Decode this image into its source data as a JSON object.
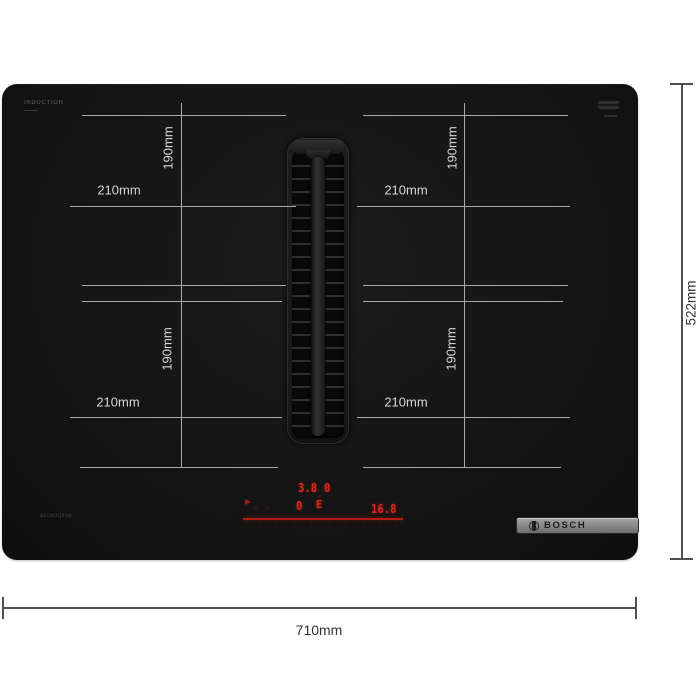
{
  "page": {
    "background": "#ffffff"
  },
  "hob": {
    "markings": {
      "top_left": "INDUCTION",
      "bottom_left": "accent|line"
    },
    "badge_brand": "BOSCH",
    "colors": {
      "surface": "#151515",
      "display_red": "#d8281c",
      "badge_gray": "#8c8c8c",
      "inner_dim_line": "#a8a8a8",
      "outer_dim_line": "#4f4f4f"
    }
  },
  "zones": [
    {
      "id": "top-left",
      "width_label": "210mm",
      "height_label": "190mm"
    },
    {
      "id": "top-right",
      "width_label": "210mm",
      "height_label": "190mm"
    },
    {
      "id": "bottom-left",
      "width_label": "210mm",
      "height_label": "190mm"
    },
    {
      "id": "bottom-right",
      "width_label": "210mm",
      "height_label": "190mm"
    }
  ],
  "display": {
    "power_a": "3.8",
    "power_b": "0",
    "power_c": "0",
    "move_arrow": "→",
    "move_letter": "E",
    "aux_mark": "°",
    "timer": "16.8",
    "icon_marks": [
      "∗",
      "≡",
      "··"
    ],
    "slider_power_icon": "◌",
    "slider_numbers": [
      "1",
      "2",
      "3",
      "4",
      "5",
      "6",
      "7",
      "8",
      "9"
    ]
  },
  "outer_dimensions": {
    "width": "710mm",
    "depth": "522mm"
  }
}
